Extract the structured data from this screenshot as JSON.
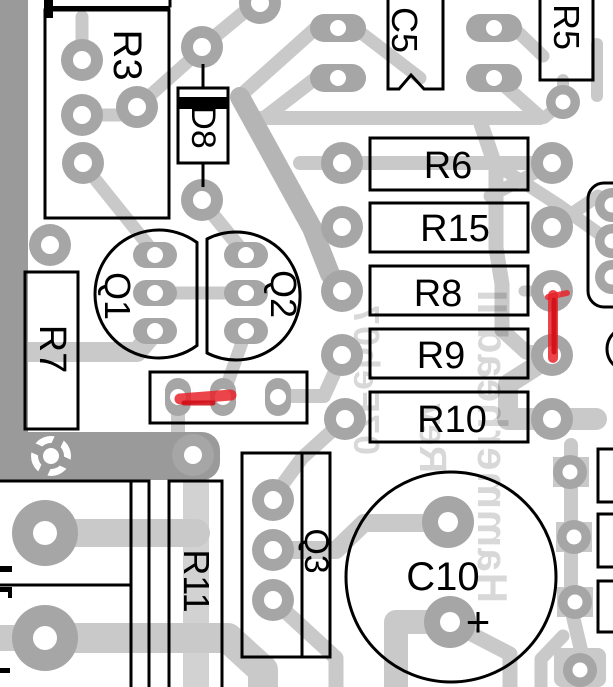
{
  "board": {
    "components": {
      "r3": "R3",
      "d8": "D8",
      "c5": "C5",
      "r5": "R5",
      "r6": "R6",
      "r15": "R15",
      "r8": "R8",
      "r9": "R9",
      "r10": "R10",
      "q1": "Q1",
      "q2": "Q2",
      "q3": "Q3",
      "r7": "R7",
      "r11": "R11",
      "c10": "C10"
    },
    "markings": {
      "polarity": "+"
    },
    "watermark": {
      "title": "Hammerhead II",
      "revision": "Rev",
      "date": "07Feb07"
    },
    "colors": {
      "background": "#ffffff",
      "trace": "#c9c9c9",
      "trace_dark": "#b5b5b5",
      "trace_light": "#d2d2d2",
      "pad": "#a6a6a6",
      "pour": "#9a9a9a",
      "outline": "#000000",
      "red": "#e8232a"
    }
  }
}
